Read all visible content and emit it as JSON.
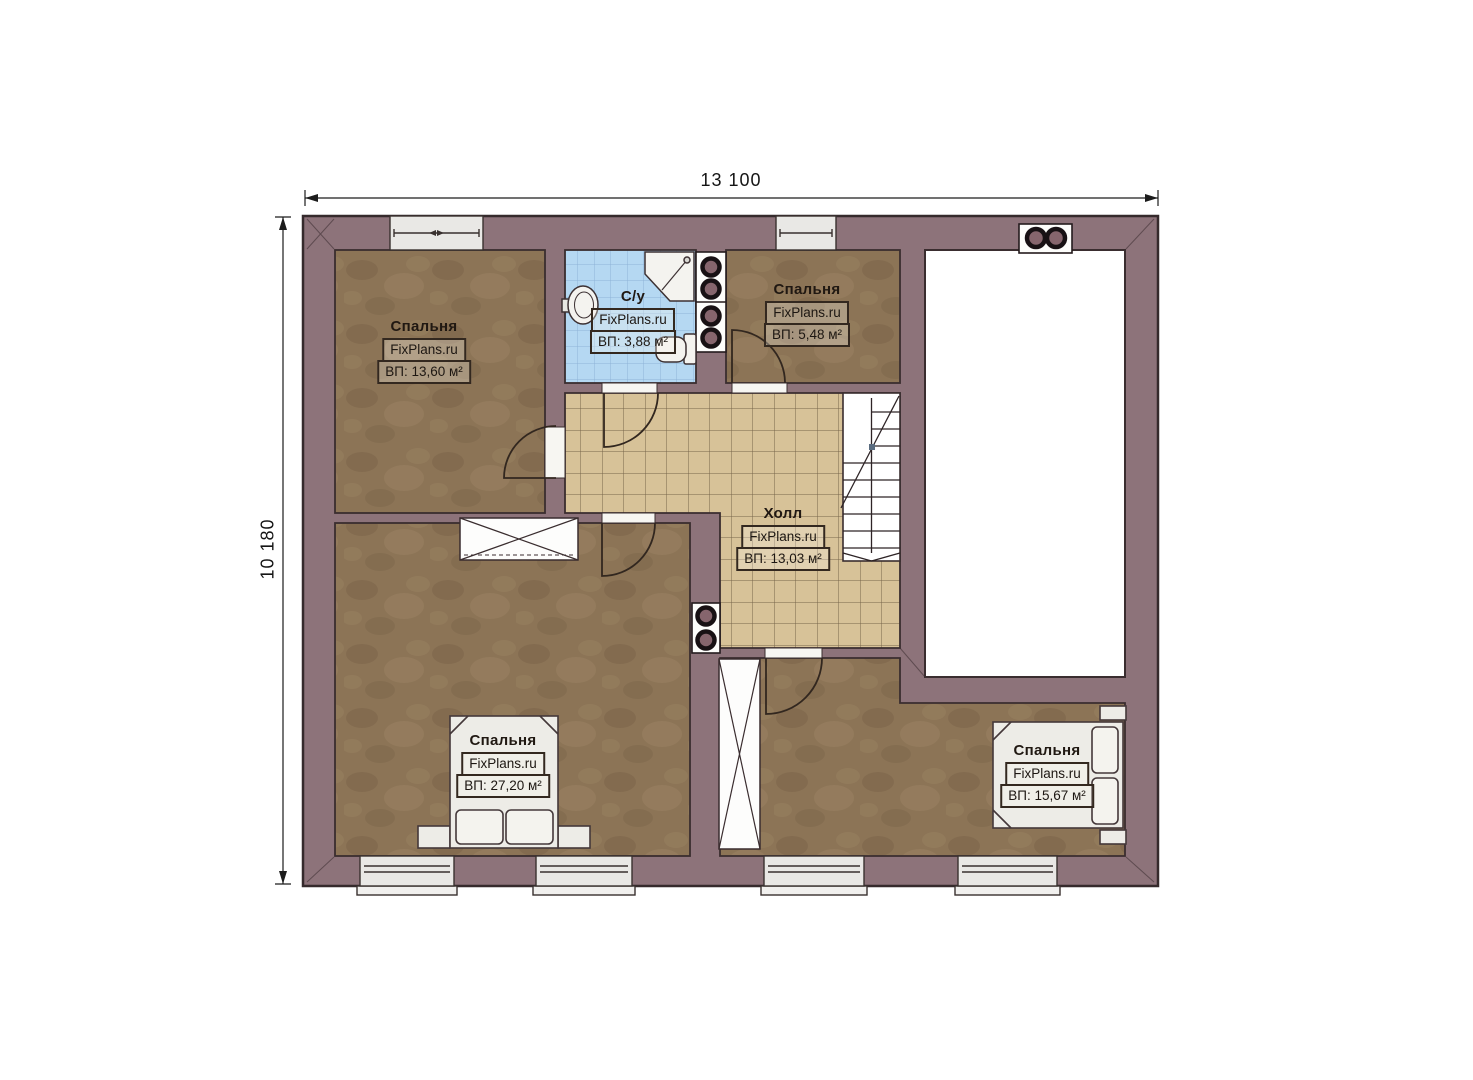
{
  "dimensions": {
    "width_label": "13 100",
    "height_label": "10 180"
  },
  "rooms": [
    {
      "id": "bedroom-top-left",
      "name": "Спальня",
      "watermark": "FixPlans.ru",
      "area": "ВП: 13,60 м²"
    },
    {
      "id": "bathroom",
      "name": "С/у",
      "watermark": "FixPlans.ru",
      "area": "ВП: 3,88 м²"
    },
    {
      "id": "bedroom-top-right",
      "name": "Спальня",
      "watermark": "FixPlans.ru",
      "area": "ВП: 5,48 м²"
    },
    {
      "id": "hall",
      "name": "Холл",
      "watermark": "FixPlans.ru",
      "area": "ВП: 13,03 м²"
    },
    {
      "id": "bedroom-bottom-left",
      "name": "Спальня",
      "watermark": "FixPlans.ru",
      "area": "ВП: 27,20 м²"
    },
    {
      "id": "bedroom-bottom-right",
      "name": "Спальня",
      "watermark": "FixPlans.ru",
      "area": "ВП: 15,67 м²"
    }
  ],
  "colors": {
    "wall": "#8d737a",
    "outline": "#3a2d2f",
    "bedroom_floor": "#8c7456",
    "hall_tile": "#d7c298",
    "bath_tile": "#b5d8f2",
    "window": "#e9e8e5",
    "void_room": "#ffffff"
  }
}
